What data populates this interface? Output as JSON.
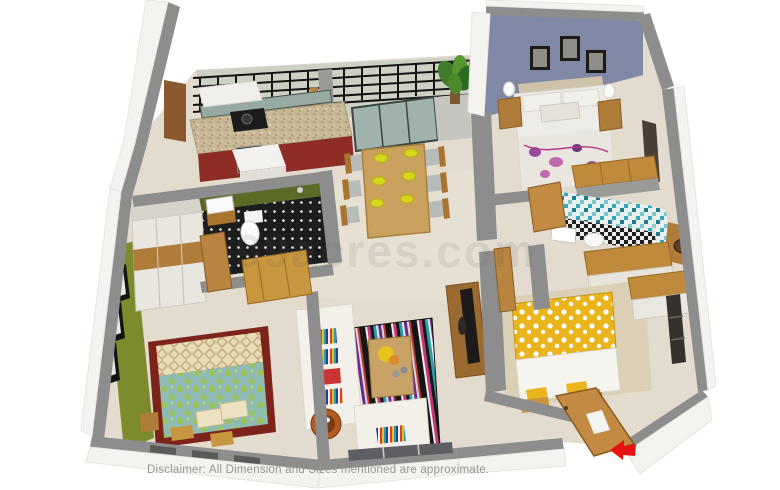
{
  "disclaimer": "Disclaimer: All Dimension and Sizes mentioned are approximate.",
  "watermark": "99acres.com",
  "colors": {
    "background": "#ffffff",
    "wall_top_gray": "#8d8d8d",
    "outer_wall_white": "#f4f3f0",
    "floor_beige": "#e2dbce",
    "master_bedroom_accent_wall_blue": "#7f88a4",
    "green_bedroom_accent_wall": "#7e8b2c",
    "green_bathroom_tile": "#5c6a28",
    "mosaic_bathroom_teal": "#2e9db0",
    "kitchen_cabinet_red": "#8e2c26",
    "kitchen_counter_granite": "#c8b796",
    "wood_furniture": "#c08a3c",
    "dining_table_wood": "#c9a05c",
    "plate_yellow": "#d6d61e",
    "yellow_bed_duvet": "#e9b41c",
    "teal_bed_duvet": "#8fbcb2",
    "bed_rug_maroon": "#7c241c",
    "sofa_white": "#f3f0e9",
    "balcony_railing_black": "#141414",
    "entrance_arrow_red": "#e81212",
    "plant_green": "#3f7d2c",
    "tv_dark": "#1d1b19"
  },
  "rooms": [
    {
      "name": "balcony",
      "features": [
        "black-railing",
        "potted-plant",
        "glass-sliding-doors"
      ]
    },
    {
      "name": "kitchen",
      "features": [
        "granite-counter",
        "red-cabinets",
        "gas-stove",
        "chimney-hood",
        "white-island-unit"
      ]
    },
    {
      "name": "dining-area",
      "features": [
        "six-seater-wooden-table",
        "yellow-plates"
      ]
    },
    {
      "name": "master-bedroom",
      "features": [
        "blue-accent-wall",
        "three-picture-frames",
        "double-bed-floral-duvet",
        "two-nightstands-with-lamps",
        "wardrobe"
      ]
    },
    {
      "name": "mosaic-bathroom",
      "features": [
        "teal-mosaic-tiles",
        "checkered-floor",
        "washbasin",
        "toilet"
      ]
    },
    {
      "name": "green-bathroom",
      "features": [
        "green-tiles",
        "black-dotted-floor",
        "washbasin",
        "toilet",
        "shower"
      ]
    },
    {
      "name": "green-bedroom",
      "features": [
        "green-accent-wall",
        "three-picture-frames",
        "double-bed-teal-duvet",
        "wardrobe",
        "bench-stools"
      ]
    },
    {
      "name": "yellow-bedroom",
      "features": [
        "double-bed-yellow-polka-duvet",
        "wardrobe",
        "window",
        "open-entry-door"
      ]
    },
    {
      "name": "living-room",
      "features": [
        "white-sofa",
        "striped-rug",
        "coffee-table-with-flowers",
        "tv-unit",
        "round-side-table",
        "armchair"
      ]
    },
    {
      "name": "entrance",
      "features": [
        "open-wooden-door",
        "red-direction-arrow"
      ]
    }
  ]
}
